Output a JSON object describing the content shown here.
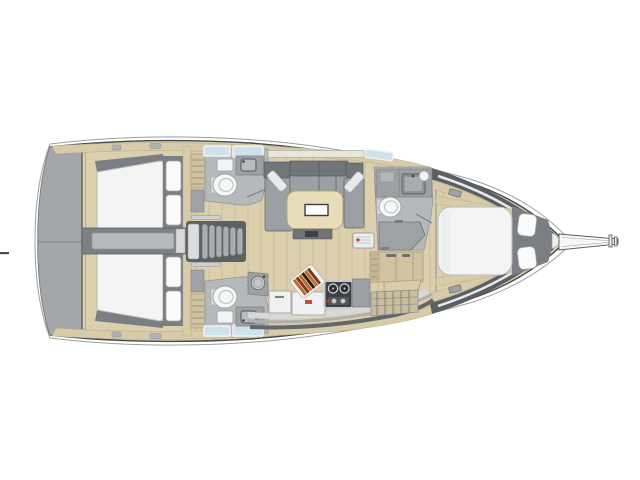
{
  "page": {
    "title": "Sailing yacht interior layout plan (top view)",
    "background": "#ffffff"
  },
  "colors": {
    "hull_outline": "#45494d",
    "outer_sheer": "#9a9ea1",
    "hull_white": "#ffffff",
    "platform_grey": "#a4a7a9",
    "platform_seam": "#7e8285",
    "transom_line": "#54585c",
    "wood_floor": "#dccfad",
    "wood_seam": "#c2b18e",
    "beige_trim": "#d8cba9",
    "beige_edge": "#b3a683",
    "cabinet_beige": "#cfc3a2",
    "dark_wedge": "#5b5f62",
    "window_strip": "#e4e9ec",
    "skylight_blue": "#cfe1eb",
    "saloon_window": "#e9e6da",
    "mattress_white": "#f3f4f3",
    "mattress_edge": "#b7babc",
    "pillow_white": "#fbfbfb",
    "pillow_edge": "#a3a6a8",
    "berth_surround": "#7b7f83",
    "corridor_grey": "#7d8184",
    "corridor_lid": "#b7babc",
    "stair_frame": "#5d6164",
    "stair_tread": "#a9adaf",
    "stair_rail": "#cdd0d1",
    "wall_grey": "#b6b9bb",
    "counter_grey": "#9da1a3",
    "basin_grey": "#b9bdbf",
    "toilet_white": "#f5f6f6",
    "fixture_edge": "#8e9294",
    "settee_back": "#71767a",
    "settee_seat": "#9aa0a4",
    "cushion_grey": "#e8eaea",
    "table_top": "#e9ddb9",
    "table_edge": "#b3a57f",
    "table_inset_border": "#3a3d40",
    "under_table_box": "#6f7377",
    "galley_white": "#eff0f0",
    "stove_body": "#3d4144",
    "stove_rim": "#c8cbcd",
    "burner_ring": "#d9dbdc",
    "accent_red": "#c83a26",
    "board_white": "#f3f4f2",
    "bread_orange": "#c06a2a",
    "bread_brown": "#7a3a16",
    "bread_dark": "#2e1f12",
    "tick_dark": "#4a4d50"
  },
  "vessel": {
    "type": "monohull sailing yacht - interior layout plan, viewed from above",
    "bow": "right",
    "stern": "left",
    "compartments": [
      {
        "id": "swim-platform",
        "label": "Open transom swim platform with centerline seam and hinge"
      },
      {
        "id": "aft-cabin-port",
        "label": "Port aft double cabin",
        "features": [
          "double berth",
          "2 pillows",
          "louvered locker"
        ]
      },
      {
        "id": "aft-cabin-starboard",
        "label": "Starboard aft double cabin",
        "features": [
          "double berth",
          "2 pillows",
          "louvered locker"
        ]
      },
      {
        "id": "companionway",
        "label": "Companionway stairs on centerline",
        "steps": 6
      },
      {
        "id": "head-aft-port",
        "label": "Port aft head",
        "fixtures": [
          "toilet",
          "sink",
          "mirror cabinet",
          "2 deck skylights"
        ]
      },
      {
        "id": "head-aft-starboard",
        "label": "Starboard aft head",
        "fixtures": [
          "toilet",
          "sink",
          "mirror cabinet",
          "2 deck skylights"
        ]
      },
      {
        "id": "saloon",
        "label": "Saloon",
        "features": [
          "U-shaped settee to port",
          "dining table with inset",
          "2 angled throw cushions",
          "hull window strip"
        ]
      },
      {
        "id": "galley",
        "label": "Galley to starboard",
        "features": [
          "round sink",
          "two white lockers",
          "cutting board with bread loaf",
          "2-burner stove with controls",
          "beige cabinet run",
          "slatted rack"
        ]
      },
      {
        "id": "head-forward",
        "label": "Forward head to port",
        "fixtures": [
          "toilet",
          "sink counter",
          "shower bench",
          "skylight"
        ]
      },
      {
        "id": "forward-cabin",
        "label": "Owner's forward cabin",
        "features": [
          "island double berth",
          "2 pillows",
          "side shelves"
        ]
      },
      {
        "id": "bow",
        "label": "Bow with anchor locker and bowsprit with anchor roller"
      }
    ]
  }
}
